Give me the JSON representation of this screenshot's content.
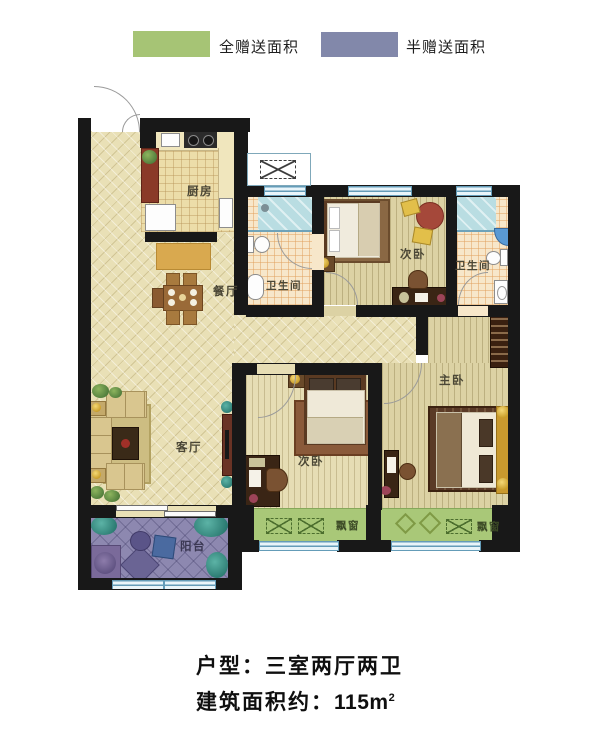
{
  "legend": {
    "full_gift": {
      "label": "全赠送面积",
      "color": "#a6c475"
    },
    "half_gift": {
      "label": "半赠送面积",
      "color": "#8288aa"
    }
  },
  "floorplan": {
    "rooms": {
      "kitchen": "厨房",
      "dining": "餐厅",
      "living": "客厅",
      "bathroom1": "卫生间",
      "bathroom2": "卫生间",
      "bedroom_top": "次卧",
      "bedroom_bottom": "次卧",
      "master": "主卧",
      "balcony": "阳台",
      "bay_window1": "飘窗",
      "bay_window2": "飘窗"
    }
  },
  "footer": {
    "unit_type": "户型：三室两厅两卫",
    "area_label": "建筑面积约：",
    "area_value": "115m",
    "area_superscript": "2"
  }
}
